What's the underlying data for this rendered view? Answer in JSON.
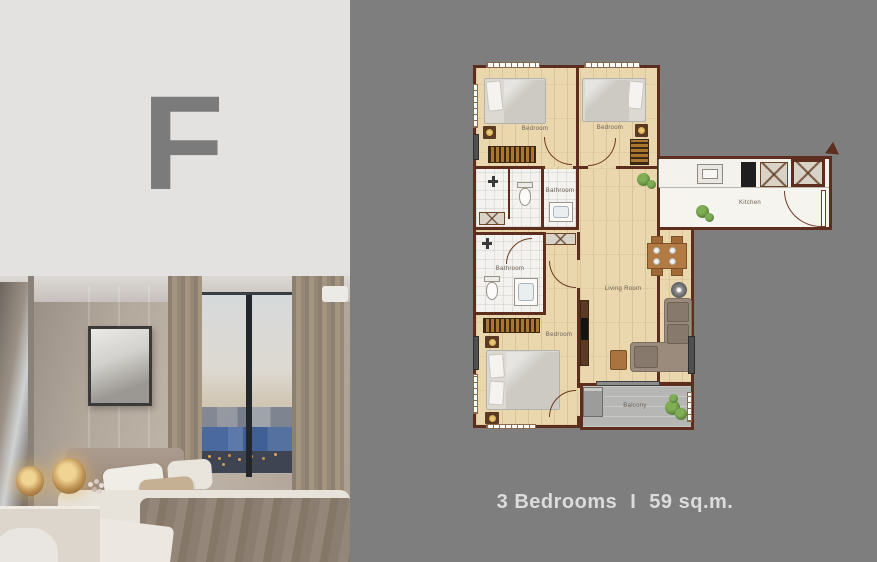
{
  "unit": {
    "letter": "F"
  },
  "caption": {
    "bedrooms_label": "3 Bedrooms",
    "separator": "I",
    "area_label": "59 sq.m."
  },
  "plan": {
    "rooms": [
      {
        "id": "bedroom-1",
        "label": "Bedroom"
      },
      {
        "id": "bedroom-2",
        "label": "Bedroom"
      },
      {
        "id": "bathroom-1",
        "label": "Bathroom"
      },
      {
        "id": "bathroom-2",
        "label": "Bathroom"
      },
      {
        "id": "bedroom-3",
        "label": "Bedroom"
      },
      {
        "id": "living-room",
        "label": "Living Room"
      },
      {
        "id": "kitchen",
        "label": "Kitchen"
      },
      {
        "id": "balcony",
        "label": "Balcony"
      }
    ]
  },
  "colors": {
    "page_background": "#7e7e7e",
    "letter_panel": "#e3e2e1",
    "unit_letter": "#7b7b7b",
    "plan_wall": "#5d2e1d",
    "plan_wood_floor": "#ead7ae",
    "plan_bath_floor": "#f3f2ee",
    "plan_balcony_floor": "#b6b6b4",
    "caption_text": "#dcdcdc"
  }
}
